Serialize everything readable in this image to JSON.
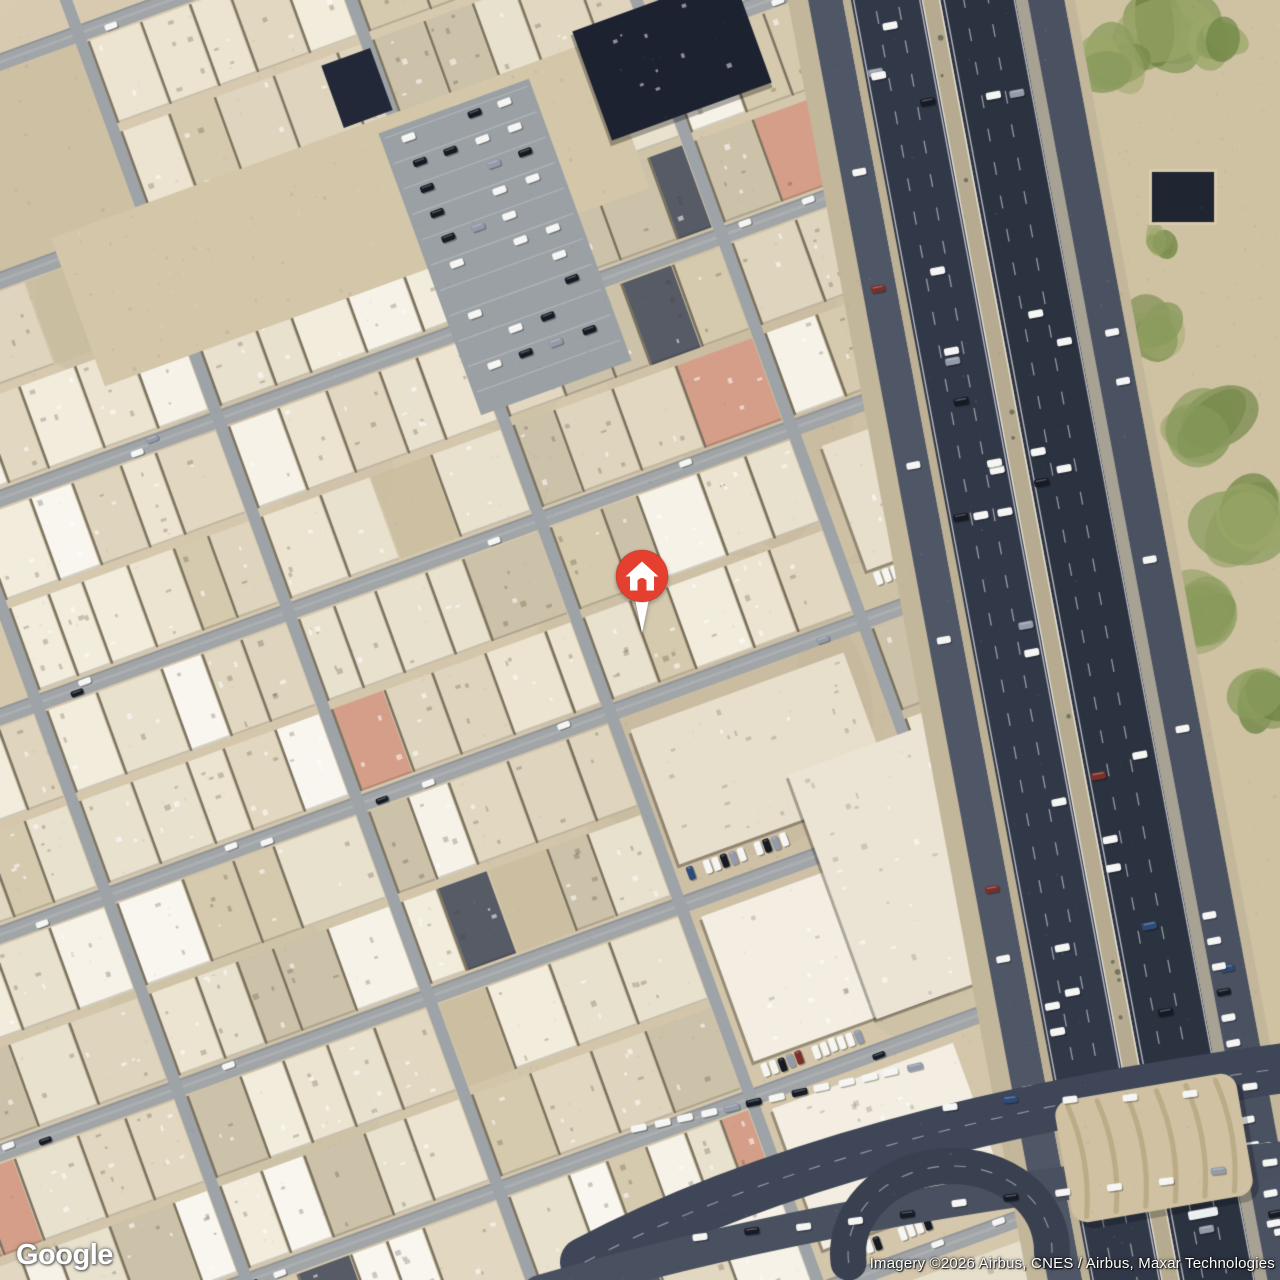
{
  "map": {
    "view_type": "satellite",
    "logo_text": "Google",
    "attribution_text": "Imagery ©2026 Airbus, CNES / Airbus, Maxar Technologies",
    "marker": {
      "icon": "home",
      "x": 642,
      "y": 576
    }
  },
  "palette": {
    "sand_base": "#d8cbb1",
    "sand_mid": "#d2c5a9",
    "sand_dark": "#c9bc9e",
    "street": "#a1a5a8",
    "cross_street": "#9ea3a7",
    "asphalt_main": "#313848",
    "asphalt_main2": "#2b3240",
    "asphalt_service": "#4f5666",
    "median_sand": "#b6ab90",
    "verge_sand": "#c3b79b",
    "building_tones": [
      "#ece4d0",
      "#f2ecdc",
      "#e2d8c1",
      "#d5c9ae",
      "#f6f2e8",
      "#ccc1a9",
      "#e8e1ce",
      "#dfd5be"
    ],
    "building_white": "#f8f6ef",
    "building_dark_roof": "#565b66",
    "construction_dark": "#1d2231",
    "roof_salmon": "#d59e89",
    "parking_lot": "#9aa0a4",
    "green_veg": "#8a9b5e",
    "green_veg_dark": "#6f8544",
    "green_veg_light": "#9aa768",
    "car_white": "#f5f5f3",
    "car_dark": "#161a24",
    "car_gray": "#939aa8",
    "marker_red": "#e5402f",
    "marker_white": "#ffffff"
  }
}
